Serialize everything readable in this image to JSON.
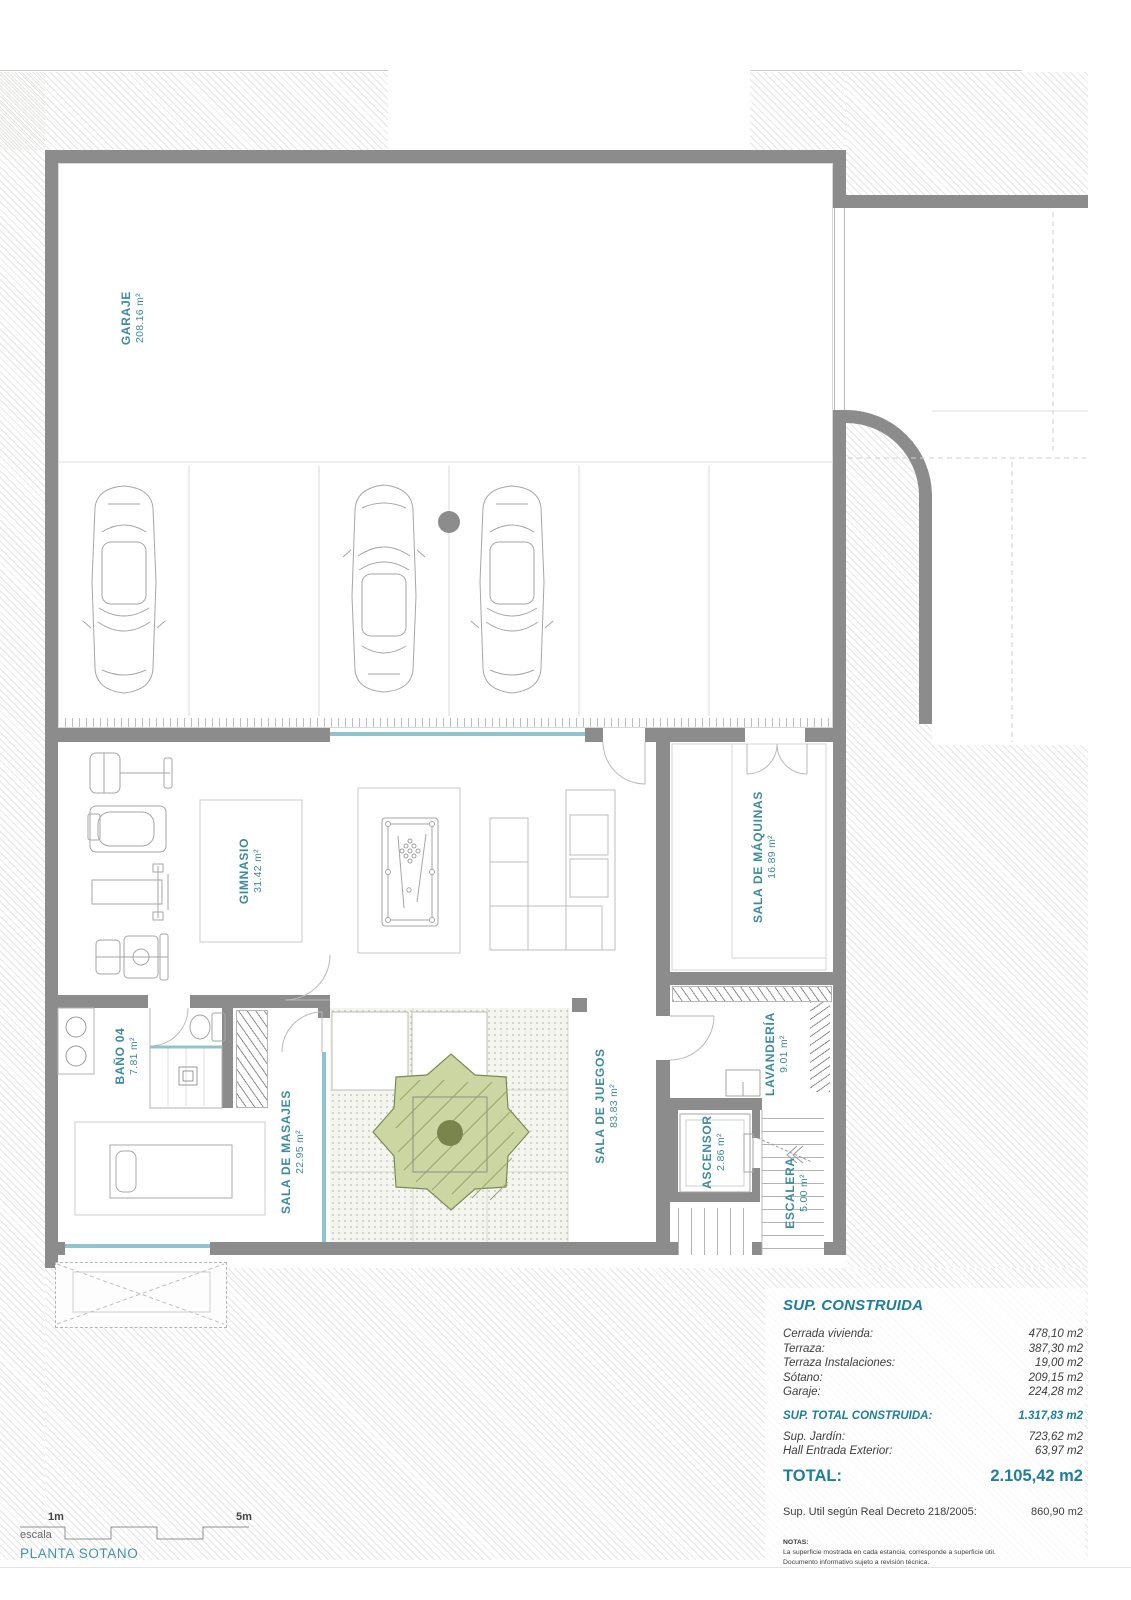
{
  "plan": {
    "title": "PLANTA SOTANO",
    "scale_label": "escala",
    "scale_mark_1": "1m",
    "scale_mark_5": "5m",
    "rooms": [
      {
        "name": "GARAJE",
        "area": "208.16 m²"
      },
      {
        "name": "GIMNASIO",
        "area": "31.42 m²"
      },
      {
        "name": "SALA DE MÁQUINAS",
        "area": "16.89 m²"
      },
      {
        "name": "BAÑO 04",
        "area": "7.81 m²"
      },
      {
        "name": "SALA DE MASAJES",
        "area": "22.95 m²"
      },
      {
        "name": "SALA DE JUEGOS",
        "area": "83.83 m²"
      },
      {
        "name": "LAVANDERÍA",
        "area": "9.01 m²"
      },
      {
        "name": "ASCENSOR",
        "area": "2.86 m²"
      },
      {
        "name": "ESCALERA",
        "area": "5.00 m²"
      }
    ]
  },
  "summary": {
    "title": "SUP. CONSTRUIDA",
    "rows": [
      {
        "label": "Cerrada vivienda:",
        "value": "478,10 m2"
      },
      {
        "label": "Terraza:",
        "value": "387,30 m2"
      },
      {
        "label": "Terraza Instalaciones:",
        "value": "19,00 m2"
      },
      {
        "label": "Sótano:",
        "value": "209,15 m2"
      },
      {
        "label": "Garaje:",
        "value": "224,28 m2"
      }
    ],
    "subtotal": {
      "label": "SUP.  TOTAL CONSTRUIDA:",
      "value": "1.317,83 m2"
    },
    "extra_rows": [
      {
        "label": "Sup. Jardín:",
        "value": "723,62 m2"
      },
      {
        "label": "Hall Entrada Exterior:",
        "value": "63,97 m2"
      }
    ],
    "total": {
      "label": "TOTAL:",
      "value": "2.105,42 m2"
    },
    "util": {
      "label": "Sup. Util según Real Decreto 218/2005:",
      "value": "860,90 m2"
    },
    "notes": {
      "title": "NOTAS:",
      "line1": "La superficie mostrada en cada estancia, corresponde a superficie útil.",
      "line2": "Documento informativo sujeto a revisión técnica."
    }
  },
  "colors": {
    "wall_gray": "#8c8c8c",
    "label_teal": "#3e8aa0",
    "summary_teal": "#1e7f9c",
    "glass_teal": "#8fc3cf",
    "tree_green": "#ccd6a2"
  }
}
